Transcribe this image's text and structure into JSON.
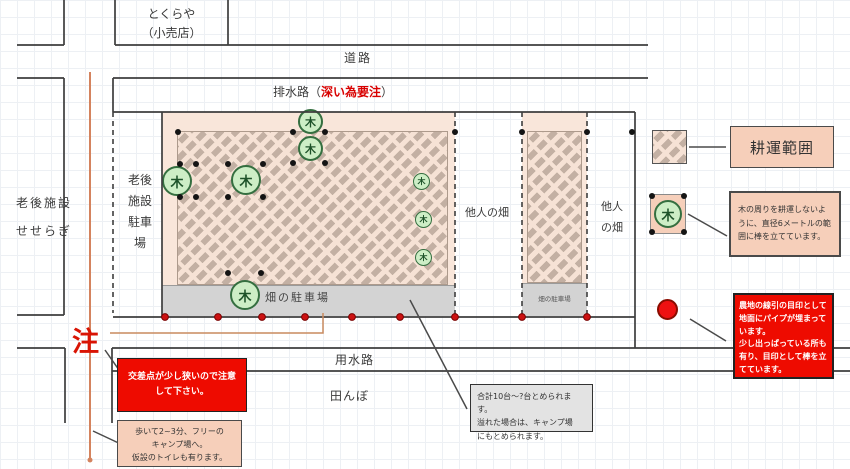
{
  "map": {
    "store": "とくらや\n（小売店）",
    "road": "道路",
    "drain_prefix": "排水路（",
    "drain_warning": "深い為要注",
    "drain_suffix": "）",
    "facility": "老後施設\nせせらぎ",
    "facility_parking": "老後\n施設\n駐車\n場",
    "field_parking": "畑の駐車場",
    "field_parking_small": "畑の駐車場",
    "others_field_a": "他人の畑",
    "others_field_b": "他人\nの畑",
    "waterway": "用水路",
    "rice_field": "田んぼ",
    "note_mark": "注",
    "tree": "木"
  },
  "legend": {
    "tilling_area": "耕運範囲",
    "tree_note": "木の周りを耕運しないように、直径6メートルの範囲に棒を立てています。",
    "pipe_note": "農地の線引の目印として地面にパイプが埋まっています。\n少し出っぱっている所も有り、目印として棒を立てています。"
  },
  "notes": {
    "crossing": "交差点が少し狭いので注意\nして下さい。",
    "camp": "歩いて2~3分、フリーの\nキャンプ場へ。\n仮設のトイレも有ります。",
    "capacity": "合計10台～?台とめられます。\n溢れた場合は、キャンプ場\nにもとめられます。"
  },
  "colors": {
    "warning_red": "#ee0b00",
    "field_peach": "#f9e6da",
    "hatch_brown": "#c3b0a3",
    "tree_green": "#cdeec6",
    "marker_red": "#cc1111",
    "route_orange": "#d4835e"
  }
}
